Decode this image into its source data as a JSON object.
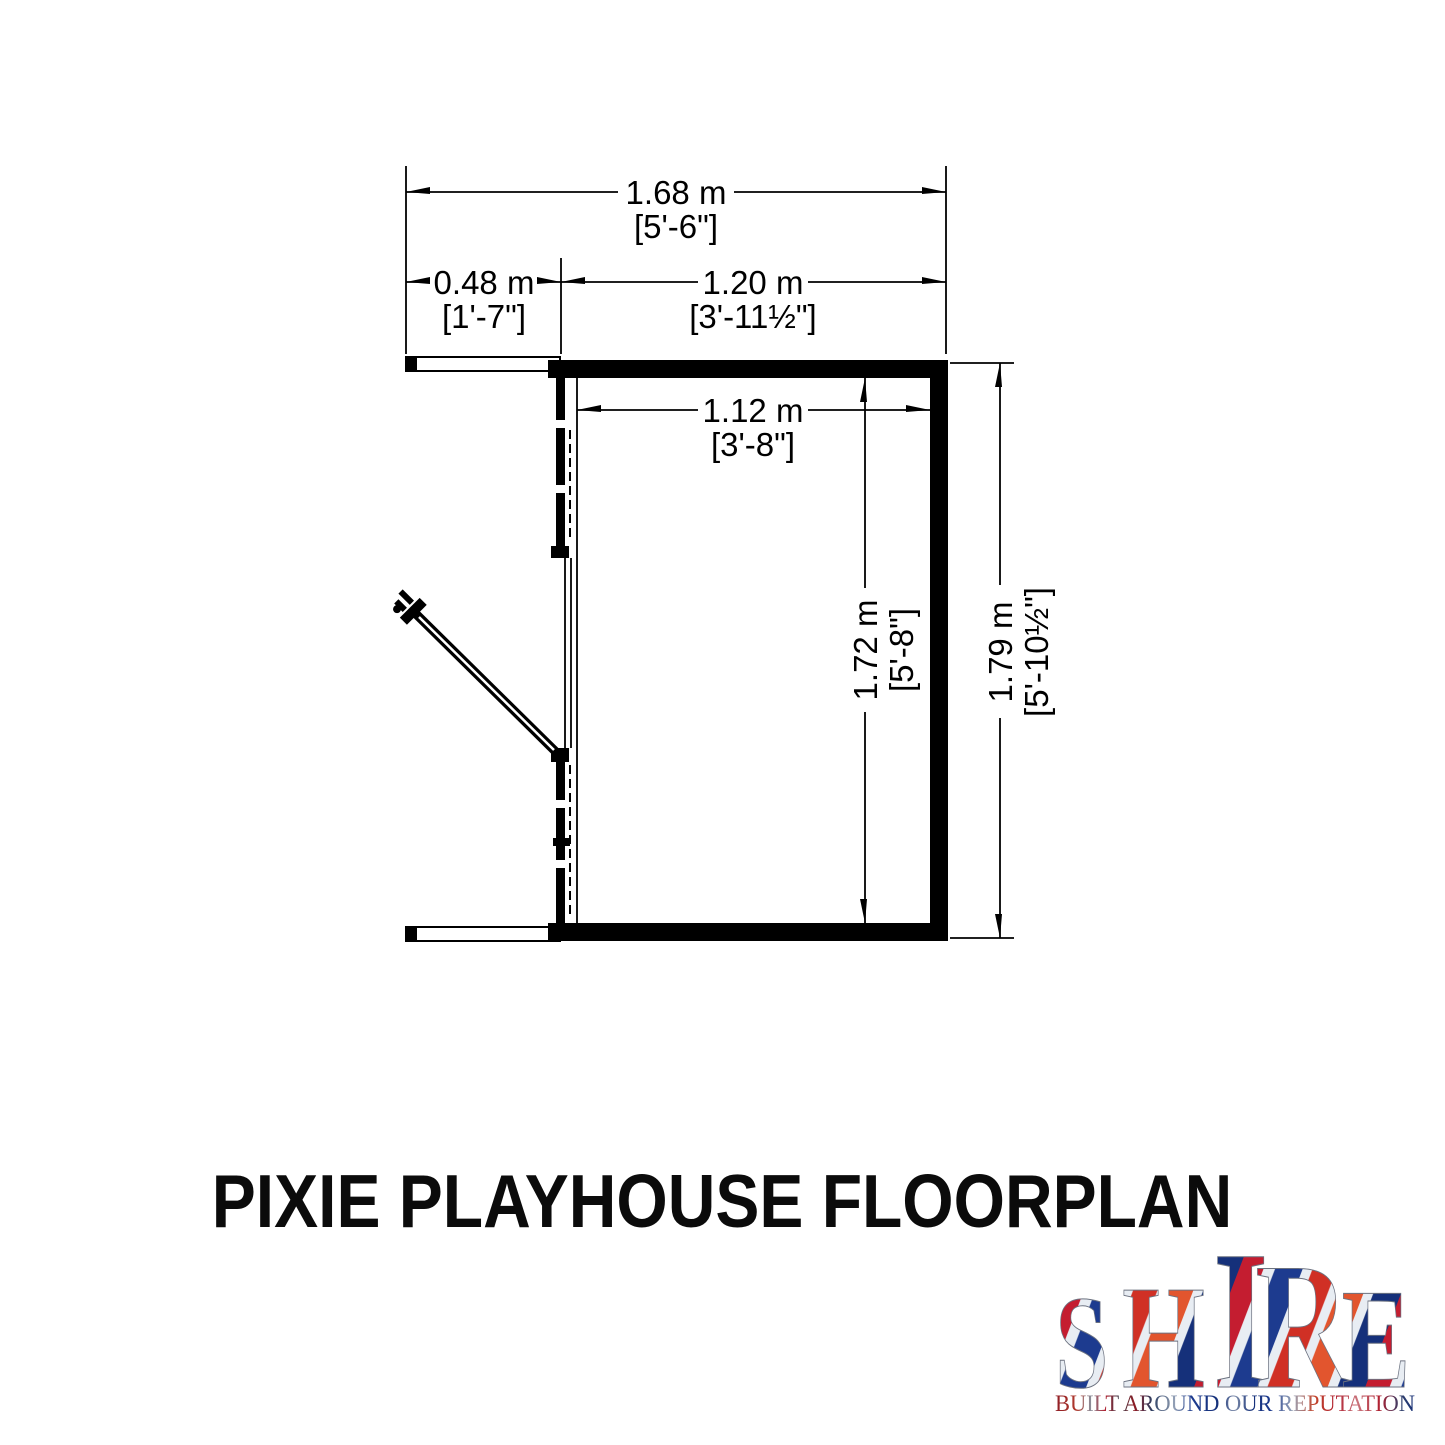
{
  "page": {
    "title": "PIXIE PLAYHOUSE FLOORPLAN",
    "background": "#ffffff",
    "line_color": "#000000"
  },
  "floorplan": {
    "dimensions": {
      "overall_width": {
        "metric": "1.68 m",
        "imperial": "[5'-6\"]"
      },
      "porch_depth": {
        "metric": "0.48 m",
        "imperial": "[1'-7\"]"
      },
      "building_width": {
        "metric": "1.20 m",
        "imperial": "[3'-11½\"]"
      },
      "internal_width": {
        "metric": "1.12 m",
        "imperial": "[3'-8\"]"
      },
      "internal_depth": {
        "metric": "1.72 m",
        "imperial": "[5'-8\"]"
      },
      "overall_depth": {
        "metric": "1.79 m",
        "imperial": "[5'-10½\"]"
      }
    }
  },
  "logo": {
    "letters": [
      "S",
      "H",
      "I",
      "R",
      "E"
    ],
    "tagline": "BUILT AROUND OUR REPUTATION",
    "colors": {
      "red": "#c41d30",
      "red2": "#d03025",
      "orange": "#e2552e",
      "blue": "#1d3b8f",
      "navy": "#15307a",
      "silver": "#e8edf3"
    }
  }
}
